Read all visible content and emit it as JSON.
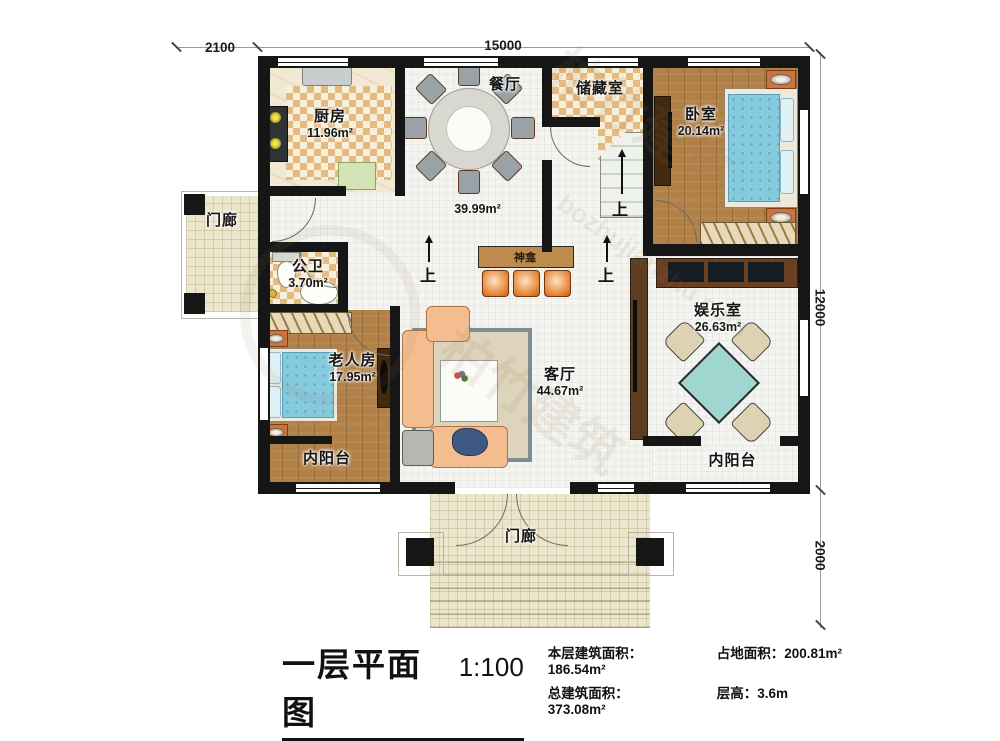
{
  "watermark": {
    "brand": "柏竹建筑",
    "site": "bozhujianzhu.com"
  },
  "dims": {
    "top_left": "2100",
    "top": "15000",
    "right": "12000",
    "right_bottom": "2000"
  },
  "annotations": {
    "up": "上",
    "shrine": "神龛",
    "hall_area": "39.99m²"
  },
  "rooms": {
    "kitchen": {
      "name": "厨房",
      "area": "11.96m²"
    },
    "dining": {
      "name": "餐厅"
    },
    "storage": {
      "name": "储藏室"
    },
    "bedroom": {
      "name": "卧室",
      "area": "20.14m²"
    },
    "bath": {
      "name": "公卫",
      "area": "3.70m²"
    },
    "elder": {
      "name": "老人房",
      "area": "17.95m²"
    },
    "living": {
      "name": "客厅",
      "area": "44.67m²"
    },
    "game": {
      "name": "娱乐室",
      "area": "26.63m²"
    },
    "balcony_left": {
      "name": "内阳台"
    },
    "balcony_right": {
      "name": "内阳台"
    },
    "porch_left": {
      "name": "门廊"
    },
    "porch_bottom": {
      "name": "门廊"
    }
  },
  "footer": {
    "title": "一层平面图",
    "scale": "1:100",
    "stats": [
      {
        "label": "本层建筑面积：",
        "value": "186.54m²"
      },
      {
        "label": "占地面积：",
        "value": "200.81m²"
      },
      {
        "label": "总建筑面积：",
        "value": "373.08m²"
      },
      {
        "label": "层高：",
        "value": "3.6m"
      }
    ]
  },
  "colors": {
    "wall": "#161616",
    "checker_tile": "#e3ba80",
    "wood_floor": "#b28147",
    "mattress_blue": "#86cade",
    "mahjong_table": "#9fd6cf",
    "stool_orange": "#e08b4a"
  }
}
